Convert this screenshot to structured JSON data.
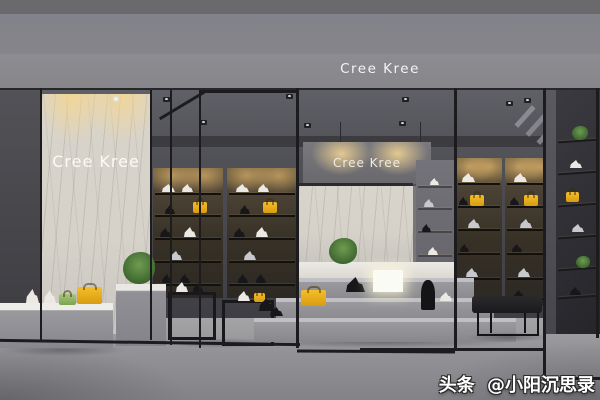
{
  "scene": {
    "description": "3D rendered interior of a footwear boutique with black metal frame shelving, marble brand panels, stepped gray display plinths, shoes and yellow handbags",
    "brand": "Cree Kree"
  },
  "signs": {
    "fascia_logo": "Cree Kree",
    "left_panel_logo": "Cree Kree",
    "center_sign_logo": "Cree Kree"
  },
  "watermark": {
    "prefix": "头条",
    "handle": "@小阳沉思录"
  },
  "palette": {
    "fascia_gray": "#8b8a8e",
    "ceiling_dark": "#4b4b51",
    "marble_light": "#d7d3cb",
    "warm_glow": "#f0cf8e",
    "floor_gray": "#97969a",
    "frame_black": "#1c1c1f",
    "platform_gray": "#8e8e93",
    "accent_yellow": "#e9b125",
    "plant_green": "#4c7a3c",
    "bench_black": "#1d1d20"
  }
}
